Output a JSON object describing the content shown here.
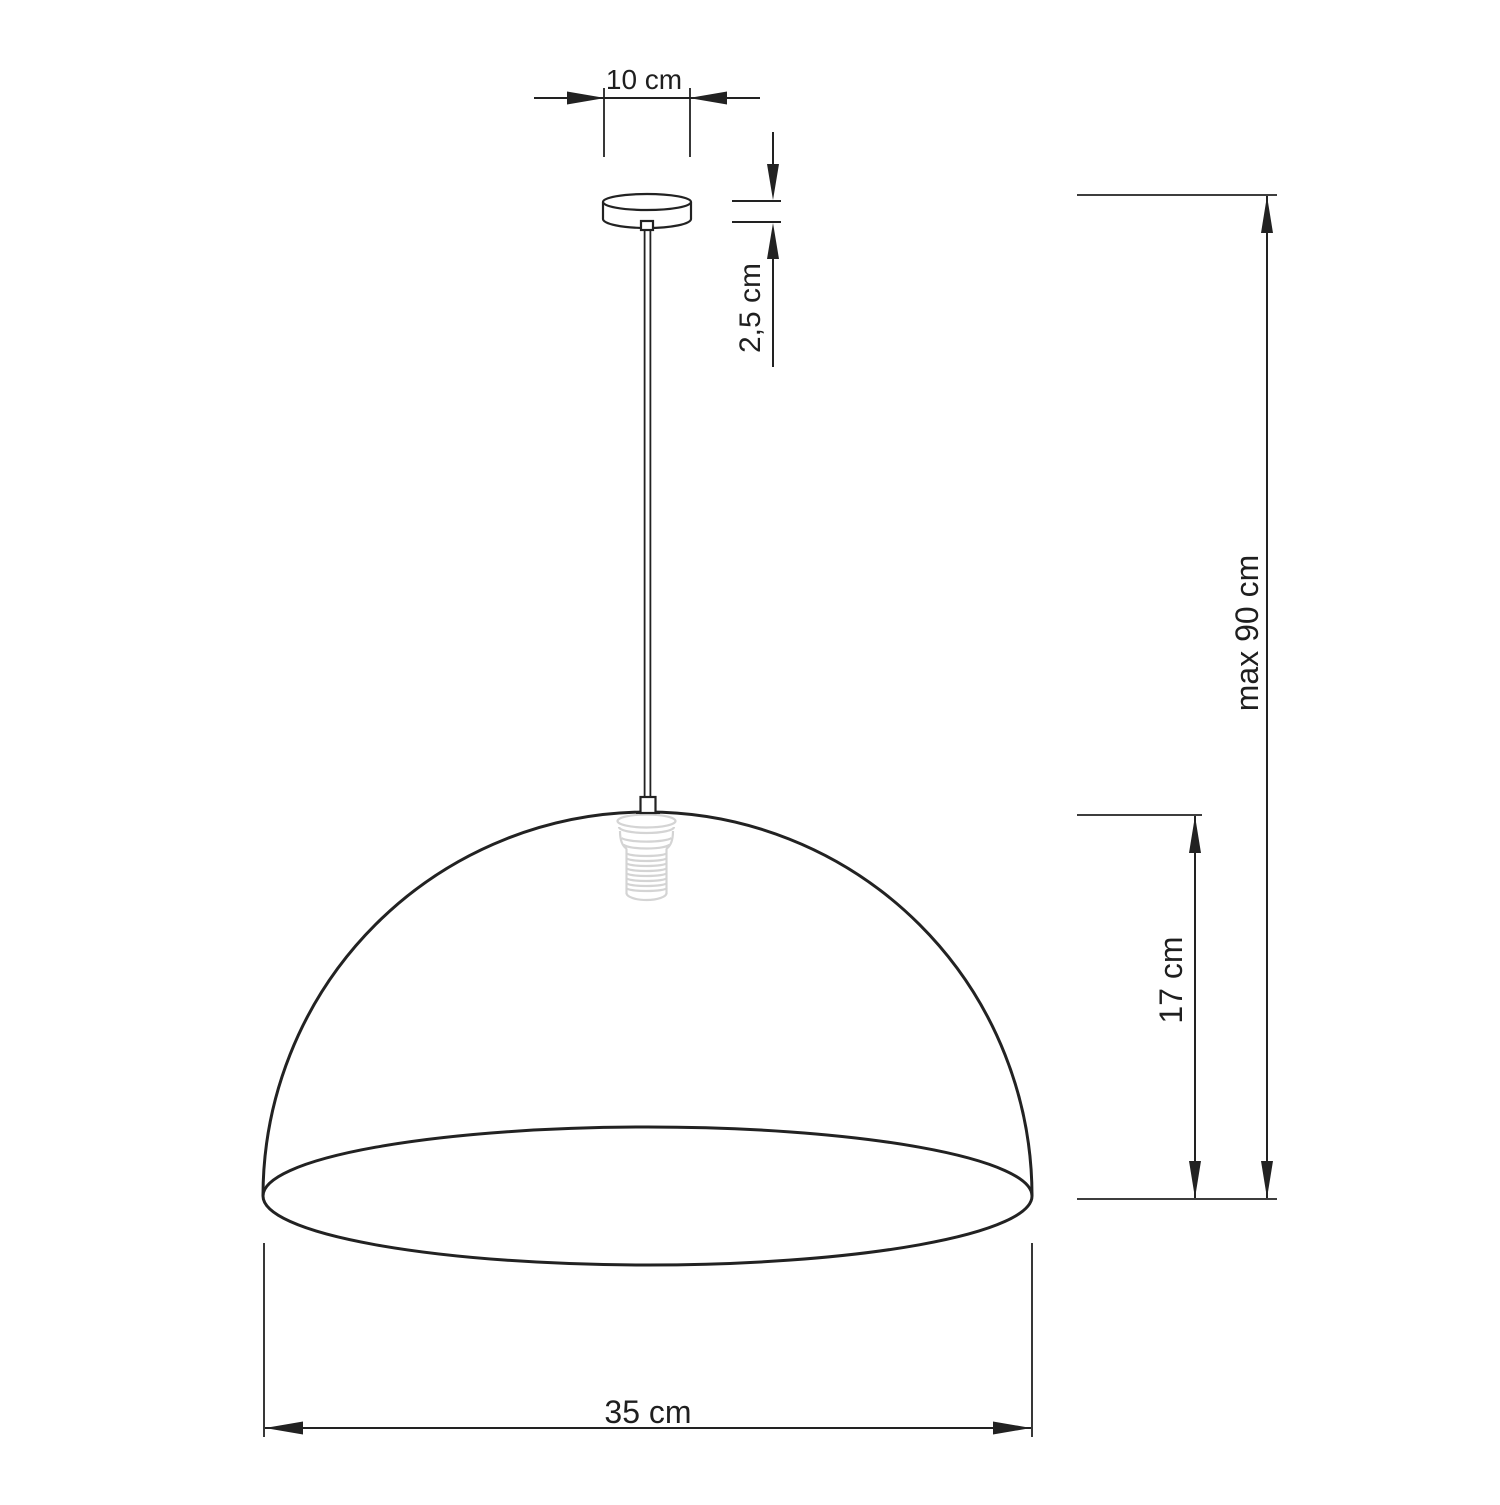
{
  "colors": {
    "background": "#ffffff",
    "line": "#222222",
    "ghost": "#d4d4d4"
  },
  "dimensions": {
    "canopy_width": {
      "label": "10 cm"
    },
    "canopy_height": {
      "label": "2,5 cm"
    },
    "max_height": {
      "label": "max 90 cm"
    },
    "shade_height": {
      "label": "17 cm"
    },
    "shade_width": {
      "label": "35 cm"
    }
  }
}
